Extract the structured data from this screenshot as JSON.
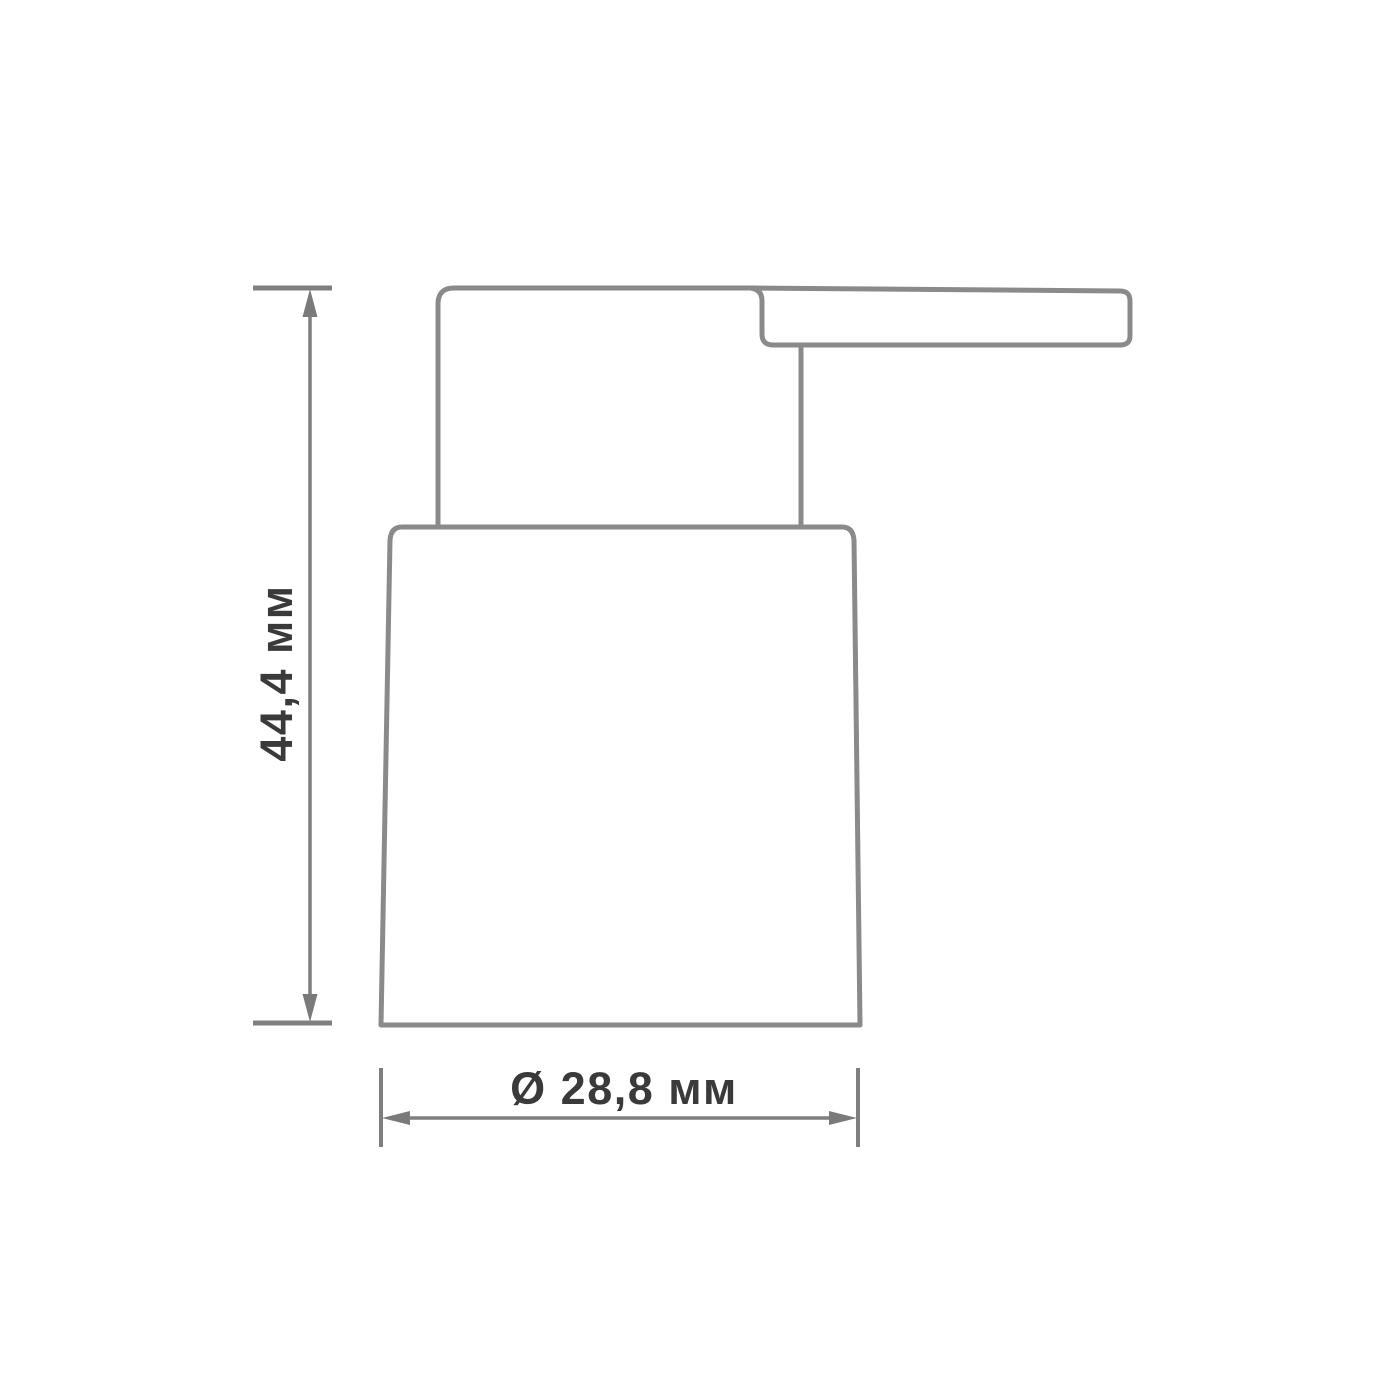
{
  "drawing": {
    "dimensions": {
      "height_label": "44,4 мм",
      "width_label": "Ø 28,8 мм"
    },
    "colors": {
      "background": "#ffffff",
      "outline": "#8a8a8a",
      "dimension_lines": "#7f7f7f",
      "arrows": "#7a7a7a",
      "label_text": "#3a3a3a"
    }
  }
}
